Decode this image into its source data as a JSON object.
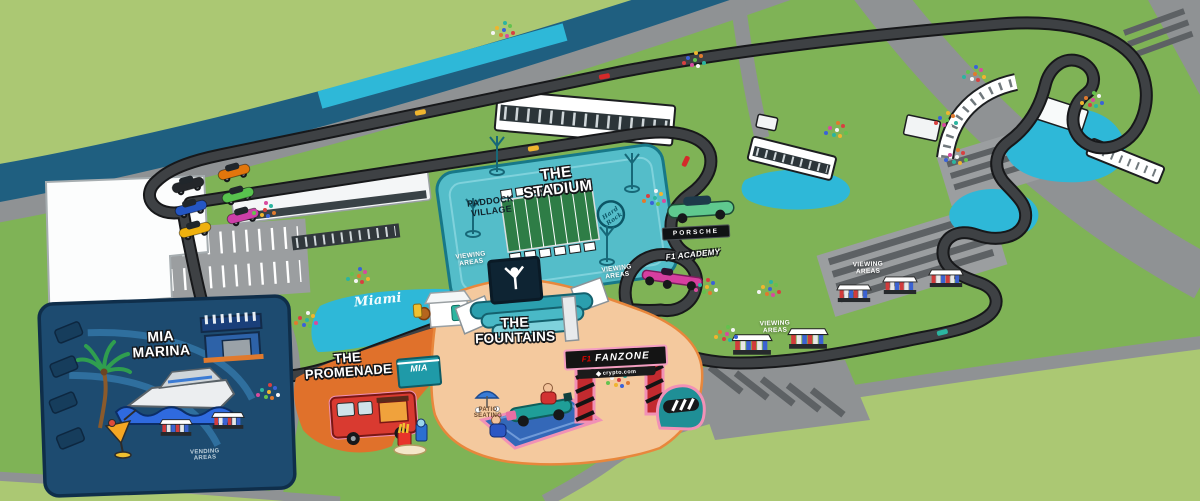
{
  "palette": {
    "outer_green": "#abc873",
    "venue_green": "#7fb356",
    "canal_blue": "#1f5f80",
    "road_grey": "#8f9294",
    "track_grey": "#3e4144",
    "track_edge": "#17181a",
    "runoff_cyan": "#2eb8d8",
    "stadium_teal": "#54bdc9",
    "stadium_teal_dark": "#177888",
    "marina_navy": "#1d4b70",
    "promenade_orange": "#e0712b",
    "fountains_peach": "#f4c99e",
    "fanzone_red": "#c22a2f",
    "accent_pink": "#f191b6"
  },
  "areas": {
    "stadium": {
      "label": "THE STADIUM",
      "sublabel": "PADDOCK VILLAGE"
    },
    "mia_marina": {
      "label": "MIA MARINA"
    },
    "promenade": {
      "label": "THE PROMENADE"
    },
    "fountains": {
      "label": "THE FOUNTAINS",
      "patio_label": "PATIO SEATING"
    },
    "fanzone": {
      "label": "FANZONE",
      "f1_logo": "F1",
      "sponsor": "crypto.com"
    }
  },
  "signs": {
    "hard_rock": "Hard Rock",
    "porsche": "PORSCHE",
    "f1_academy": "F1 ACADEMY",
    "miami_script": "Miami",
    "mia_shop": "MIA"
  },
  "labels": {
    "viewing_areas": "VIEWING AREAS",
    "vending_areas": "VENDING AREAS"
  }
}
